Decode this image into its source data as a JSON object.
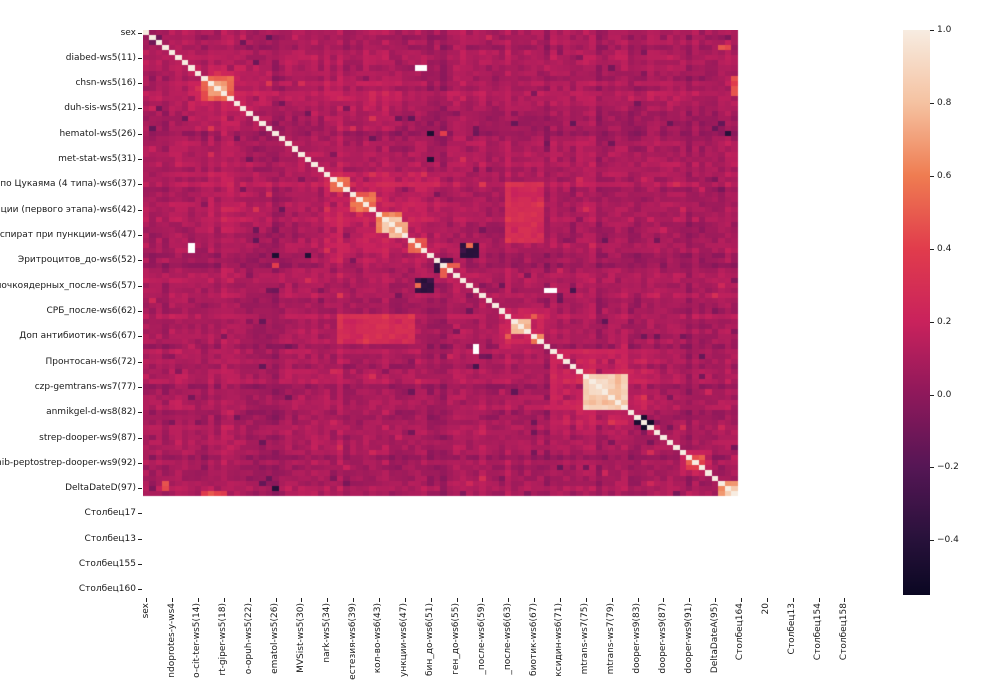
{
  "chart_data": {
    "type": "heatmap",
    "title": "",
    "description": "Correlation matrix heatmap (seaborn rocket colormap) of clinical dataset columns; trailing empty columns render as white NaN cells",
    "colormap": "rocket",
    "vmin": -0.55,
    "vmax": 1.0,
    "matrix_size": 112,
    "colored_size": 92,
    "base": 0.1,
    "diagonal_value": 1.0,
    "x_tick_step": 4,
    "y_tick_step": 5,
    "y_labels": [
      "sex",
      "diabed-ws5(11)",
      "chsn-ws5(16)",
      "duh-sis-ws5(21)",
      "hematol-ws5(26)",
      "met-stat-ws5(31)",
      "ЛИ по Цукаяма (4 типа)-ws6(37)",
      "ерации (первого этапа)-ws6(42)",
      "й аспират при пункции-ws6(47)",
      "Эритроцитов_до-ws6(52)",
      "Палочкоядерных_после-ws6(57)",
      "СРБ_после-ws6(62)",
      "Доп антибиотик-ws6(67)",
      "Пронтосан-ws6(72)",
      "czp-gemtrans-ws7(77)",
      "anmikgel-d-ws8(82)",
      "strep-dooper-ws9(87)",
      "pinib-peptostrep-dooper-ws9(92)",
      "DeltaDateD(97)",
      "Столбец17",
      "Столбец13",
      "Столбец155",
      "Столбец160"
    ],
    "x_labels": [
      "sex",
      "ndoprotes-y-ws4",
      "o-cit-ter-ws5(14)",
      "rt-giper-ws5(18)",
      "o-opuh-ws5(22)",
      "ematol-ws5(26)",
      "MVSist-ws5(30)",
      "nark-ws5(34)",
      "естезия-ws6(39)",
      "кол-во-ws6(43)",
      "ункции-ws6(47)",
      "бин_до-ws6(51)",
      "ген_до-ws6(55)",
      "_после-ws6(59)",
      "_после-ws6(63)",
      "биотик-ws6(67)",
      "ксидин-ws6(71)",
      "mtrans-ws7(75)",
      "mtrans-ws7(79)",
      "dooper-ws9(83)",
      "dooper-ws9(87)",
      "dooper-ws9(91)",
      "DeltaDateA(95)",
      "Столбец164",
      "20",
      "Столбец13",
      "Столбец154",
      "Столбец158"
    ],
    "colorbar_ticks": [
      "1.0",
      "0.8",
      "0.6",
      "0.4",
      "0.2",
      "0.0",
      "−0.2",
      "−0.4"
    ],
    "colorbar_tick_values": [
      1.0,
      0.8,
      0.6,
      0.4,
      0.2,
      0.0,
      -0.2,
      -0.4
    ],
    "colormap_stops": [
      {
        "v": 1.0,
        "c": "#F7ECE1"
      },
      {
        "v": 0.8,
        "c": "#F5C2A1"
      },
      {
        "v": 0.6,
        "c": "#EF7C51"
      },
      {
        "v": 0.4,
        "c": "#E13C4C"
      },
      {
        "v": 0.2,
        "c": "#C9225C"
      },
      {
        "v": 0.0,
        "c": "#8E185B"
      },
      {
        "v": -0.2,
        "c": "#551655"
      },
      {
        "v": -0.4,
        "c": "#27113A"
      },
      {
        "v": -0.55,
        "c": "#0A0722"
      }
    ],
    "stripes": {
      "0": 0.02,
      "12": 0.02,
      "20": -0.03,
      "27": -0.03,
      "30": 0.02,
      "37": 0.03,
      "44": -0.02,
      "46": -0.04,
      "47": -0.03,
      "56": 0.03,
      "58": 0.02,
      "62": -0.04,
      "66": -0.03,
      "69": 0.03,
      "70": -0.02,
      "76": -0.05,
      "77": -0.04,
      "84": -0.03,
      "91": -0.03
    },
    "blocks": [
      {
        "op": "add",
        "r": 7,
        "c": 7,
        "w": 13,
        "h": 13,
        "val": 0.07
      },
      {
        "op": "add",
        "r": 8,
        "c": 28,
        "w": 12,
        "h": 12,
        "val": 0.05
      },
      {
        "op": "add",
        "r": 28,
        "c": 28,
        "w": 19,
        "h": 19,
        "val": 0.08
      },
      {
        "op": "add",
        "r": 30,
        "c": 56,
        "w": 6,
        "h": 6,
        "val": 0.16
      },
      {
        "op": "add",
        "r": 36,
        "c": 56,
        "w": 6,
        "h": 6,
        "val": 0.2
      },
      {
        "op": "add",
        "r": 55,
        "c": 55,
        "w": 8,
        "h": 8,
        "val": 0.1
      },
      {
        "op": "add",
        "r": 63,
        "c": 63,
        "w": 15,
        "h": 15,
        "val": 0.09
      },
      {
        "op": "add",
        "r": 83,
        "c": 83,
        "w": 5,
        "h": 5,
        "val": 0.12
      },
      {
        "op": "set",
        "r": 9,
        "c": 9,
        "w": 5,
        "h": 5,
        "val": 0.5,
        "jit": 0.18
      },
      {
        "op": "set",
        "r": 10,
        "c": 10,
        "w": 3,
        "h": 3,
        "val": 0.72,
        "jit": 0.1
      },
      {
        "op": "set",
        "r": 29,
        "c": 29,
        "w": 3,
        "h": 3,
        "val": 0.55,
        "jit": 0.12
      },
      {
        "op": "set",
        "r": 32,
        "c": 33,
        "w": 3,
        "h": 3,
        "val": 0.55,
        "jit": 0.15
      },
      {
        "op": "set",
        "r": 36,
        "c": 36,
        "w": 4,
        "h": 4,
        "val": 0.62,
        "jit": 0.1
      },
      {
        "op": "set",
        "r": 37,
        "c": 37,
        "w": 3,
        "h": 3,
        "val": 0.85,
        "jit": 0.06
      },
      {
        "op": "set",
        "r": 38,
        "c": 39,
        "w": 2,
        "h": 2,
        "val": 0.75,
        "jit": 0.1
      },
      {
        "op": "set",
        "r": 41,
        "c": 42,
        "w": 2,
        "h": 2,
        "val": 0.5,
        "jit": 0.12
      },
      {
        "op": "set",
        "r": 42,
        "c": 49,
        "w": 3,
        "h": 3,
        "val": -0.35,
        "jit": 0.12
      },
      {
        "op": "set",
        "r": 42,
        "c": 50,
        "w": 1,
        "h": 1,
        "val": 0.55
      },
      {
        "op": "set",
        "r": 45,
        "c": 46,
        "w": 2,
        "h": 2,
        "val": -0.32,
        "jit": 0.1
      },
      {
        "op": "set",
        "r": 47,
        "c": 46,
        "w": 1,
        "h": 2,
        "val": 0.5
      },
      {
        "op": "set",
        "r": 20,
        "c": 44,
        "w": 1,
        "h": 1,
        "val": -0.45
      },
      {
        "op": "set",
        "r": 20,
        "c": 46,
        "w": 1,
        "h": 1,
        "val": 0.4
      },
      {
        "op": "set",
        "r": 20,
        "c": 90,
        "w": 1,
        "h": 1,
        "val": -0.4
      },
      {
        "op": "set",
        "r": 44,
        "c": 25,
        "w": 1,
        "h": 1,
        "val": -0.42
      },
      {
        "op": "set",
        "r": 51,
        "c": 66,
        "w": 1,
        "h": 1,
        "val": -0.25
      },
      {
        "op": "set",
        "r": 57,
        "c": 57,
        "w": 3,
        "h": 3,
        "val": 0.78,
        "jit": 0.08
      },
      {
        "op": "set",
        "r": 60,
        "c": 60,
        "w": 2,
        "h": 2,
        "val": 0.6,
        "jit": 0.1
      },
      {
        "op": "set",
        "r": 56,
        "c": 60,
        "w": 1,
        "h": 1,
        "val": 0.5
      },
      {
        "op": "set",
        "r": 68,
        "c": 68,
        "w": 5,
        "h": 5,
        "val": 0.85,
        "jit": 0.08
      },
      {
        "op": "set",
        "r": 69,
        "c": 69,
        "w": 3,
        "h": 3,
        "val": 0.93,
        "jit": 0.04
      },
      {
        "op": "set",
        "r": 68,
        "c": 73,
        "w": 2,
        "h": 7,
        "val": 0.8,
        "jit": 0.1
      },
      {
        "op": "set",
        "r": 74,
        "c": 68,
        "w": 5,
        "h": 1,
        "val": 0.88,
        "jit": 0.05
      },
      {
        "op": "set",
        "r": 77,
        "c": 76,
        "w": 1,
        "h": 1,
        "val": -0.45
      },
      {
        "op": "set",
        "r": 78,
        "c": 77,
        "w": 1,
        "h": 1,
        "val": -0.5
      },
      {
        "op": "set",
        "r": 84,
        "c": 84,
        "w": 3,
        "h": 3,
        "val": 0.45,
        "jit": 0.15
      },
      {
        "op": "set",
        "r": 89,
        "c": 89,
        "w": 3,
        "h": 3,
        "val": 0.68,
        "jit": 0.12
      },
      {
        "op": "set",
        "r": 90,
        "c": 90,
        "w": 2,
        "h": 2,
        "val": 0.85,
        "jit": 0.06
      },
      {
        "op": "set",
        "r": 9,
        "c": 91,
        "w": 1,
        "h": 4,
        "val": 0.45,
        "jit": 0.15
      },
      {
        "op": "set",
        "r": 89,
        "c": 3,
        "w": 1,
        "h": 2,
        "val": 0.45,
        "jit": 0.1
      }
    ],
    "nan_cells": [
      {
        "r": 7,
        "c": 42,
        "w": 2,
        "h": 1
      },
      {
        "r": 51,
        "c": 62,
        "w": 2,
        "h": 1
      }
    ]
  },
  "layout": {
    "plot_left": 143,
    "plot_top": 30,
    "plot_width": 724,
    "plot_height": 567,
    "y_label_right": 848,
    "y_mark_left": 138,
    "x_label_top": 603,
    "x_mark_top": 598,
    "cbar_left": 903,
    "cbar_top": 30,
    "cbar_width": 27,
    "cbar_height": 565,
    "cbar_mark_left": 930,
    "cbar_label_left": 937
  }
}
